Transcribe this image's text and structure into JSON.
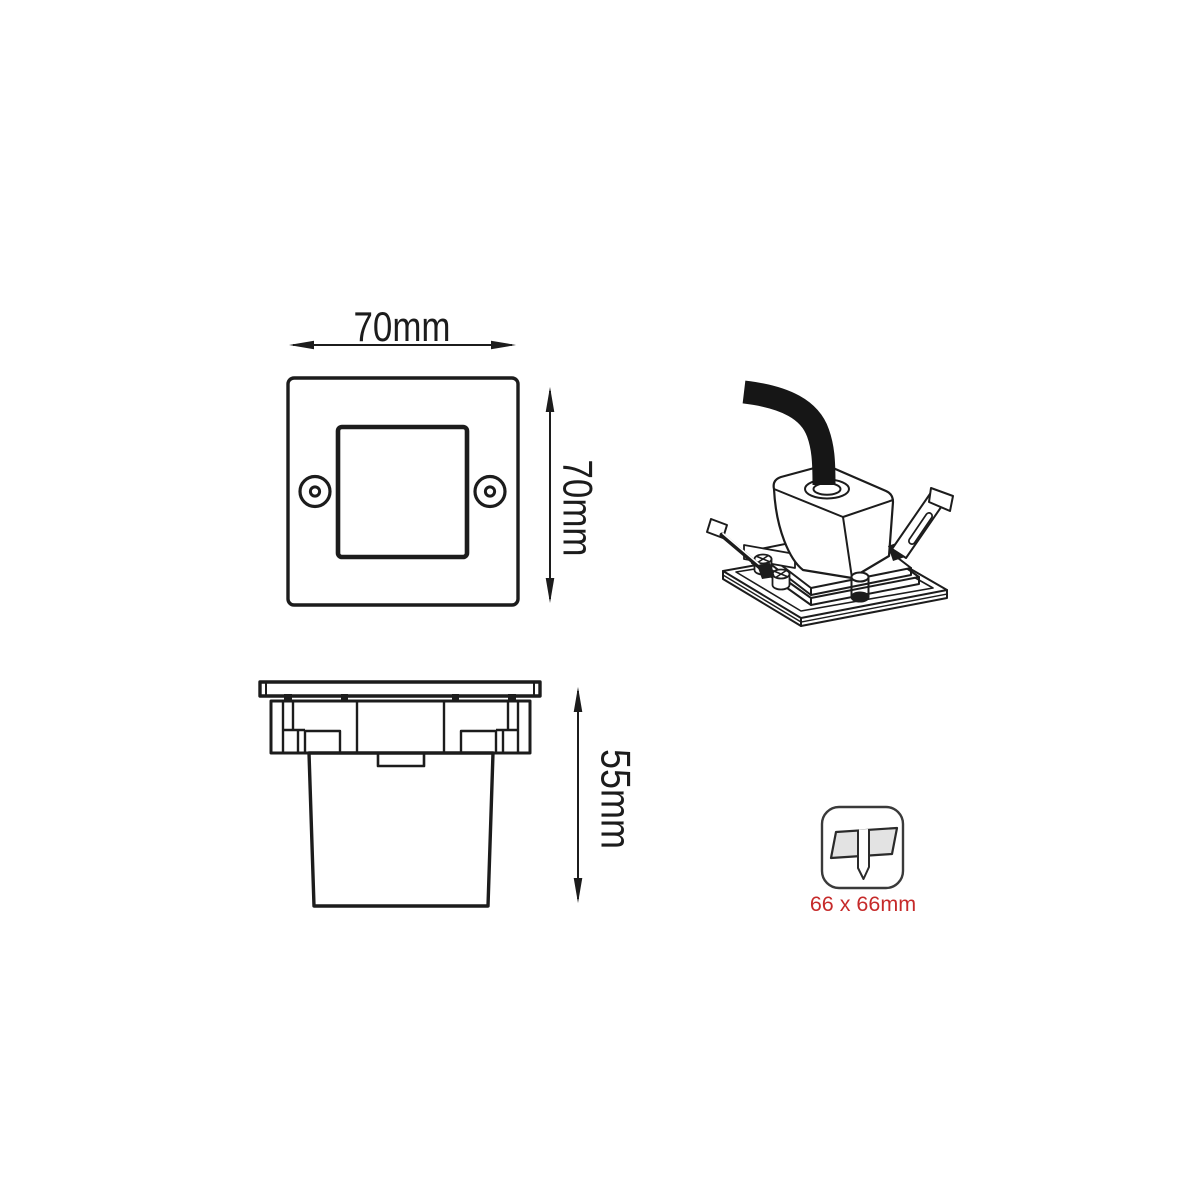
{
  "front_view": {
    "width_label": "70mm",
    "height_label": "70mm"
  },
  "side_view": {
    "depth_label": "55mm"
  },
  "cutout": {
    "size_label": "66 x 66mm"
  },
  "colors": {
    "line": "#1c1c1c",
    "accent_red": "#c62a2a",
    "icon_gray": "#e3e3e3"
  }
}
